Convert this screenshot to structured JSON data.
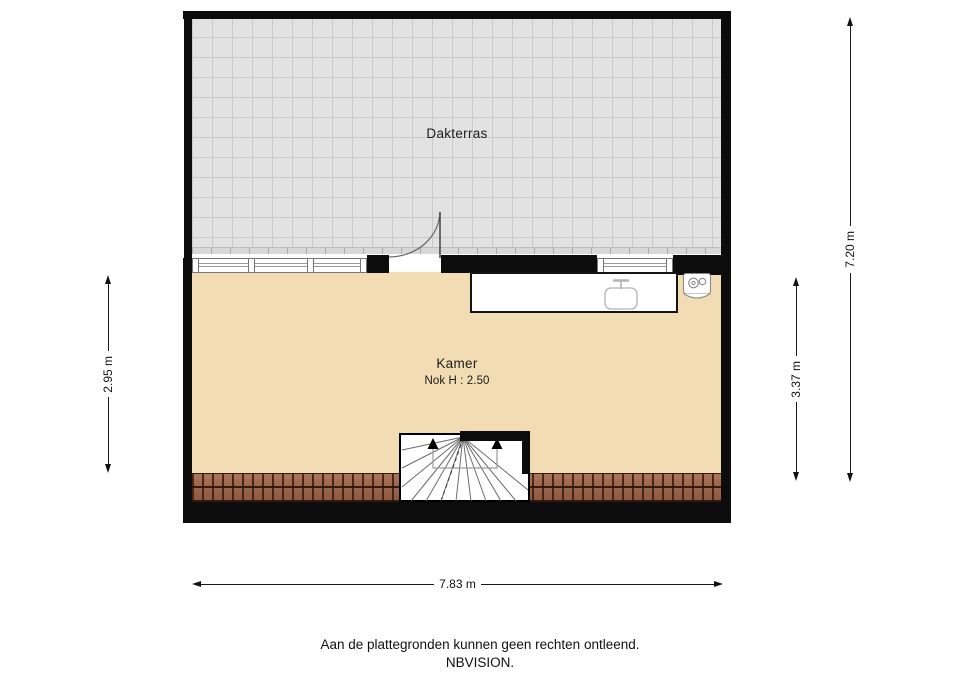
{
  "rooms": {
    "dakterras": {
      "label": "Dakterras"
    },
    "kamer": {
      "label": "Kamer",
      "ridge_height": "Nok H : 2.50"
    }
  },
  "dimensions": {
    "kamer_depth_left": "2.95 m",
    "total_depth_right": "7.20 m",
    "kamer_depth_right": "3.37 m",
    "total_width_bottom": "7.83 m"
  },
  "footer": {
    "disclaimer": "Aan de plattegronden kunnen geen rechten ontleend.",
    "brand": "NBVISION."
  },
  "colors": {
    "wall": "#0c0c0c",
    "terrace_fill": "#e2e2e2",
    "terrace_grid": "#c9c9c9",
    "floor_fill": "#f2dcb3",
    "roof_tile": "#9c6751",
    "fixture_line": "#b3b3b3"
  }
}
